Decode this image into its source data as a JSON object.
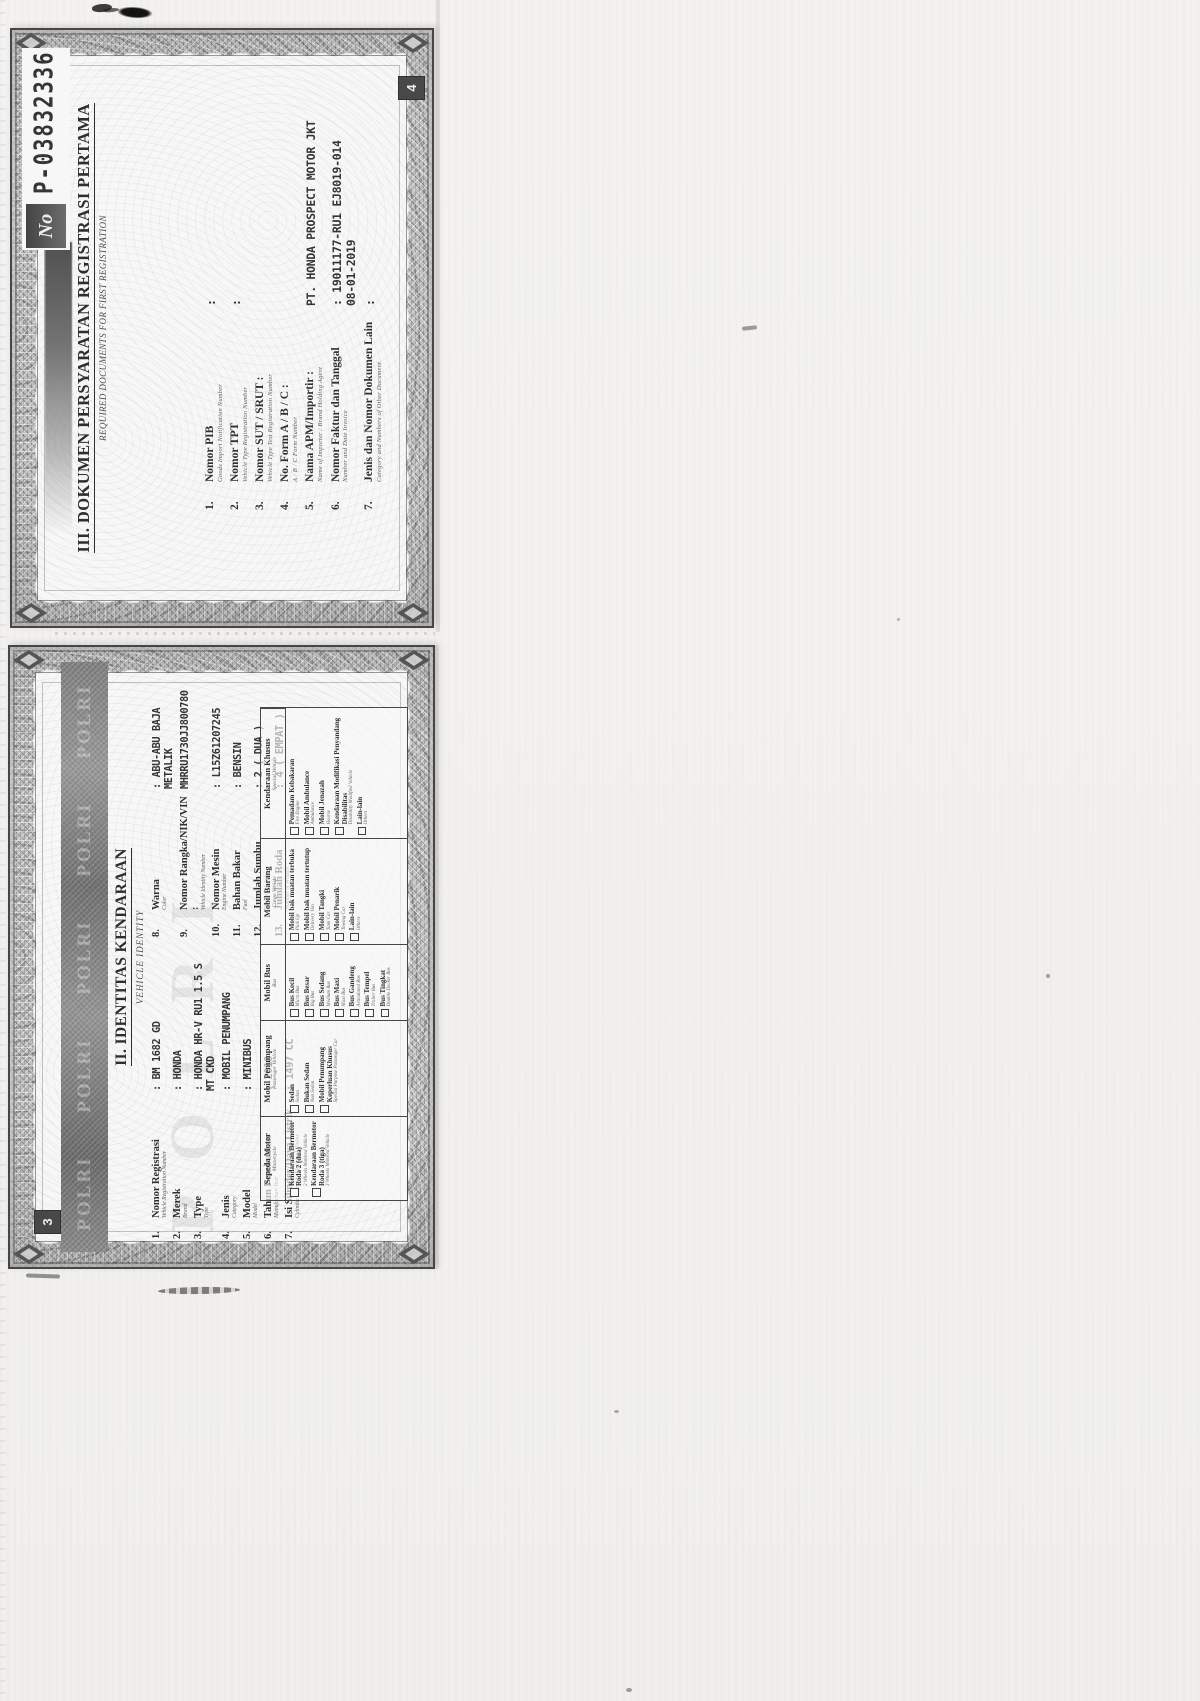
{
  "document": {
    "serial_prefix": "No",
    "serial_number": "P-03832336"
  },
  "page4": {
    "page_number": "4",
    "title": "III. DOKUMEN PERSYARATAN REGISTRASI PERTAMA",
    "subtitle": "REQUIRED DOCUMENTS FOR FIRST REGISTRATION",
    "items": [
      {
        "num": "1.",
        "label": "Nomor PIB",
        "sub": "Goods Import Notification Number",
        "value": ":"
      },
      {
        "num": "2.",
        "label": "Nomor TPT",
        "sub": "Vehicle Type Registration Number",
        "value": ":"
      },
      {
        "num": "3.",
        "label": "Nomor SUT / SRUT :",
        "sub": "Vehicle Type Test Registration Number",
        "value": ""
      },
      {
        "num": "4.",
        "label": "No. Form A / B / C :",
        "sub": "A / B / C Form Number",
        "value": ""
      },
      {
        "num": "5.",
        "label": "Nama APM/Importir :",
        "sub": "Name of Importer / Brand Holding Agent",
        "value": "PT. HONDA PROSPECT MOTOR JKT"
      },
      {
        "num": "6.",
        "label": "Nomor Faktur dan Tanggal",
        "sub": "Number and Date Invoice",
        "value": ": 19011177-RU1 EJ8019-014",
        "value2": "08-01-2019"
      },
      {
        "num": "7.",
        "label": "Jenis dan Nomor Dokumen Lain",
        "sub": "Category and Numbers of Other Document",
        "value": ":"
      }
    ]
  },
  "page3": {
    "page_number": "3",
    "watermark": "POLRI",
    "band_words": [
      {
        "word": "POLRI"
      },
      {
        "word": "POLRI"
      },
      {
        "word": "POLRI"
      },
      {
        "word": "POLRI"
      },
      {
        "word": "POLRI"
      }
    ],
    "title": "II. IDENTITAS KENDARAAN",
    "subtitle": "VEHICLE IDENTITY",
    "fields_left": [
      {
        "num": "1.",
        "label": "Nomor Registrasi",
        "sub": "Vehicle Registration Number",
        "value": ": BM 1682 GD"
      },
      {
        "num": "2.",
        "label": "Merek",
        "sub": "Brand",
        "value": ": HONDA"
      },
      {
        "num": "3.",
        "label": "Type",
        "sub": "Type",
        "value": ": HONDA HR-V RU1 1.5 S",
        "value2": "MT CKD"
      },
      {
        "num": "4.",
        "label": "Jenis",
        "sub": "Category",
        "value": ": MOBIL PENUMPANG"
      },
      {
        "num": "5.",
        "label": "Model",
        "sub": "Model",
        "value": ": MINIBUS"
      },
      {
        "num": "6.",
        "label": "Tahun Pembuatan",
        "sub": "Manufacture Year",
        "value": ": 2018"
      },
      {
        "num": "7.",
        "label": "Isi Silinder/Daya Listrik",
        "sub": "Cylinder Capacity/Electrical Power",
        "value": ": 1497 CC"
      }
    ],
    "fields_right": [
      {
        "num": "8.",
        "label": "Warna",
        "sub": "Color",
        "value": ": ABU-ABU BAJA",
        "value2": "METALIK"
      },
      {
        "num": "9.",
        "label": "Nomor Rangka/NIK/VIN :",
        "sub": "Vehicle Identity Number",
        "value": "MHRRU1730JJ800780"
      },
      {
        "num": "10.",
        "label": "Nomor Mesin",
        "sub": "Engine Number",
        "value": ": L15Z61207245"
      },
      {
        "num": "11.",
        "label": "Bahan Bakar",
        "sub": "Fuel",
        "value": ": BENSIN"
      },
      {
        "num": "12.",
        "label": "Jumlah Sumbu",
        "sub": "Number of Axle",
        "value": ": 2 ( DUA )"
      },
      {
        "num": "13.",
        "label": "Jumlah Roda",
        "sub": "Number of Wheels",
        "value": ": 4 ( EMPAT )"
      }
    ],
    "table": {
      "columns": [
        {
          "header": "Sepeda Motor",
          "sub": "Motorcycle",
          "items": [
            {
              "label": "Kendaraan Bermotor Roda 2 (dua)",
              "sub": "2 Wheels Motored Vehicle",
              "checked": false
            },
            {
              "label": "Kendaraan Bermotor Roda 3 (tiga)",
              "sub": "3 Wheels Motored Vehicle",
              "checked": false
            }
          ]
        },
        {
          "header": "Mobil Penumpang",
          "sub": "Passenger Vehicle",
          "items": [
            {
              "label": "Sedan",
              "sub": "Sedan",
              "checked": false
            },
            {
              "label": "Bukan Sedan",
              "sub": "Non Sedan",
              "checked": false
            },
            {
              "label": "Mobil Penumpang Keperluan Khusus",
              "sub": "Special Purpose Passenger Car",
              "checked": false
            }
          ]
        },
        {
          "header": "Mobil Bus",
          "sub": "Bus",
          "items": [
            {
              "label": "Bus Kecil",
              "sub": "Micro Bus",
              "checked": false
            },
            {
              "label": "Bus Besar",
              "sub": "Big Bus",
              "checked": false
            },
            {
              "label": "Bus Sedang",
              "sub": "Medium Bus",
              "checked": false
            },
            {
              "label": "Bus Maxi",
              "sub": "Maxi Bus",
              "checked": false
            },
            {
              "label": "Bus Gandeng",
              "sub": "Articulated Bus",
              "checked": false
            },
            {
              "label": "Bus Tempel",
              "sub": "Trailer Bus",
              "checked": false
            },
            {
              "label": "Bus Tingkat",
              "sub": "Double Decker Bus",
              "checked": false
            }
          ]
        },
        {
          "header": "Mobil Barang",
          "sub": "Cargo Vehicle",
          "items": [
            {
              "label": "Mobil bak muatan terbuka",
              "sub": "Pick Up",
              "checked": false
            },
            {
              "label": "Mobil bak muatan tertutup",
              "sub": "Delivery Van",
              "checked": false
            },
            {
              "label": "Mobil Tangki",
              "sub": "Tank Car",
              "checked": false
            },
            {
              "label": "Mobil Penarik",
              "sub": "Towing Car",
              "checked": false
            },
            {
              "label": "Lain-lain",
              "sub": "Others",
              "checked": false
            }
          ]
        },
        {
          "header": "Kendaraan Khusus",
          "sub": "Special Vehicle",
          "items": [
            {
              "label": "Pemadam Kebakaran",
              "sub": "Fire Engine",
              "checked": false
            },
            {
              "label": "Mobil Ambulance",
              "sub": "Ambulance",
              "checked": false
            },
            {
              "label": "Mobil Jenazah",
              "sub": "Hearse",
              "checked": false
            },
            {
              "label": "Kendaraan Modifikasi Penyandang Disabilitas",
              "sub": "Disability Modified Vehicle",
              "checked": false
            },
            {
              "label": "Lain-lain",
              "sub": "Others",
              "checked": false
            }
          ]
        }
      ]
    }
  }
}
